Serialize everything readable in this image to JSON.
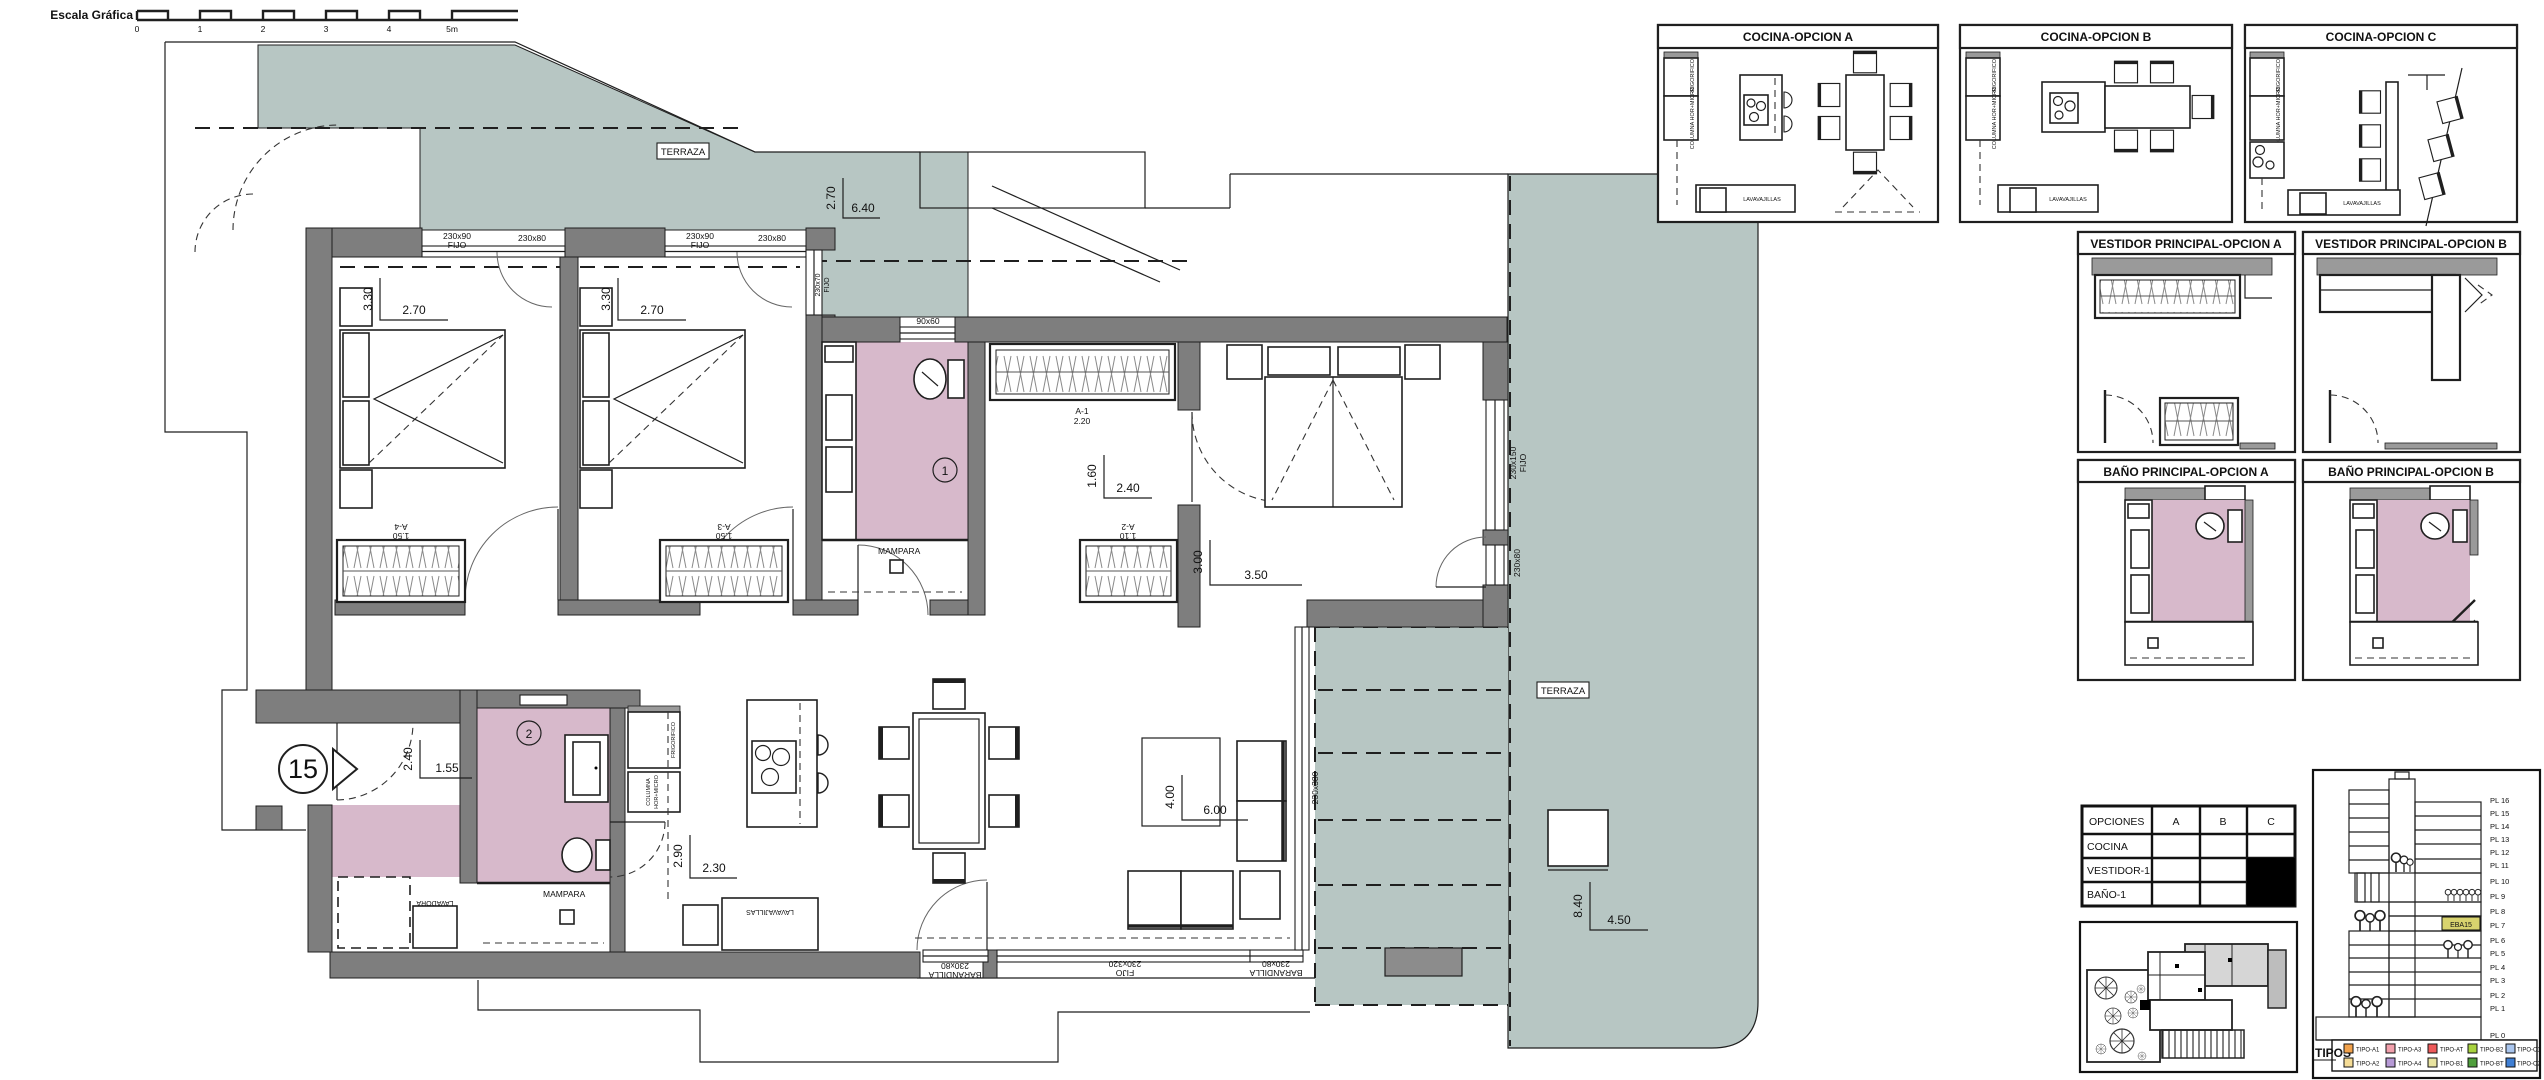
{
  "scale_bar": {
    "label": "Escala Gráfica",
    "ticks": [
      "0",
      "1",
      "2",
      "3",
      "4",
      "5m"
    ]
  },
  "unit_marker": "15",
  "colors": {
    "terraza": "#b7c6c3",
    "bath": "#d7b9cb",
    "wall": "#7e7e7e",
    "highlight": "#d8d36e"
  },
  "plan": {
    "terraza_top": {
      "label": "TERRAZA",
      "dim_v": "2.70",
      "dim_h": "6.40"
    },
    "terraza_right": {
      "label": "TERRAZA",
      "dim_v": "8.40",
      "dim_h": "4.50"
    },
    "bedroom1": {
      "dim_v": "3.30",
      "dim_h": "2.70",
      "win1": "230x90",
      "win1_type": "FIJO",
      "win2": "230x80",
      "wardrobe": "A-4",
      "wardrobe_len": "1.50"
    },
    "bedroom2": {
      "dim_v": "3.30",
      "dim_h": "2.70",
      "win1": "230x90",
      "win1_type": "FIJO",
      "win2": "230x80",
      "wardrobe": "A-3",
      "wardrobe_len": "1.50"
    },
    "bath1": {
      "number": "1",
      "screen": "MAMPARA",
      "win": "90x60",
      "side_win": "230x70",
      "side_win_type": "FIJO"
    },
    "bath2": {
      "number": "2",
      "screen": "MAMPARA",
      "dim_v": "2.40",
      "dim_h": "1.55"
    },
    "corridor": {
      "dim_v": "1.60",
      "dim_h": "2.40",
      "wardrobe": "A-1",
      "wardrobe_len": "2.20"
    },
    "master": {
      "dim_v": "3.00",
      "dim_h": "3.50",
      "wardrobe": "A-2",
      "wardrobe_len": "1.10",
      "win1": "230x150",
      "win1_type": "FIJO",
      "win2": "230x80"
    },
    "living": {
      "dim_v": "2.90",
      "dim_h": "2.30",
      "dim2_v": "4.00",
      "dim2_h": "6.00",
      "appliance": "LAVAVAJILLAS",
      "win_left": "230x80",
      "win_left_type": "BARANDILLA",
      "win_mid": "230x320",
      "win_mid_type": "FIJO",
      "win_right": "230x80",
      "win_right_type": "BARANDILLA",
      "win_side": "230x380"
    },
    "laundry": {
      "appliance": "LAVADORA"
    },
    "kitchen": {
      "fridge": "FRIGORIFICO",
      "column_l1": "COLUMNA",
      "column_l2": "HOR+MICRO"
    }
  },
  "panels": {
    "cocina_a": {
      "title": "COCINA-OPCION A"
    },
    "cocina_b": {
      "title": "COCINA-OPCION B"
    },
    "cocina_c": {
      "title": "COCINA-OPCION C"
    },
    "vestidor_a": {
      "title": "VESTIDOR PRINCIPAL-OPCION A"
    },
    "vestidor_b": {
      "title": "VESTIDOR PRINCIPAL-OPCION B"
    },
    "bano_a": {
      "title": "BAÑO PRINCIPAL-OPCION A"
    },
    "bano_b": {
      "title": "BAÑO PRINCIPAL-OPCION B"
    },
    "kitchen_labels": {
      "fridge": "FRIGORIFICO",
      "column": "COLUMNA HOR+MICRO",
      "dishwasher": "LAVAVAJILLAS"
    }
  },
  "options_table": {
    "header": [
      "OPCIONES",
      "A",
      "B",
      "C"
    ],
    "rows": [
      {
        "label": "COCINA",
        "filled": []
      },
      {
        "label": "VESTIDOR-1",
        "filled": [
          "C"
        ]
      },
      {
        "label": "BAÑO-1",
        "filled": [
          "C"
        ]
      }
    ]
  },
  "elevation": {
    "floors": [
      "PL 16",
      "PL 15",
      "PL 14",
      "PL 13",
      "PL 12",
      "PL 11",
      "PL 10",
      "PL 9",
      "PL 8",
      "PL 7",
      "PL 6",
      "PL 5",
      "PL 4",
      "PL 3",
      "PL 2",
      "PL 1",
      "PL 0"
    ],
    "highlight_unit": "EBA15",
    "legend_title": "TIPOS",
    "legend": [
      {
        "label": "TIPO-A1",
        "color": "#f2a24c"
      },
      {
        "label": "TIPO-A3",
        "color": "#f2a0ac"
      },
      {
        "label": "TIPO-AT",
        "color": "#ee5a5a"
      },
      {
        "label": "TIPO-B2",
        "color": "#a8d23e"
      },
      {
        "label": "TIPO-C1",
        "color": "#aac6ee"
      },
      {
        "label": "TIPO-A2",
        "color": "#f5dc96"
      },
      {
        "label": "TIPO-A4",
        "color": "#b79ad6"
      },
      {
        "label": "TIPO-B1",
        "color": "#e8e3a0"
      },
      {
        "label": "TIPO-BT",
        "color": "#4f9e3c"
      },
      {
        "label": "TIPO-C2",
        "color": "#3f7fd4"
      }
    ]
  }
}
